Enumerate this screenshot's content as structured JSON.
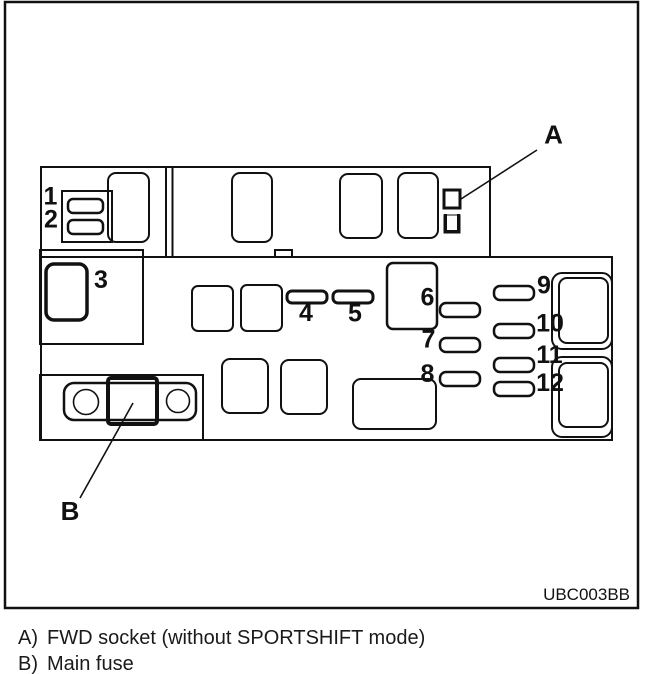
{
  "figure_code": "UBC003BB",
  "callouts": {
    "a": "A",
    "b": "B"
  },
  "fuse_labels": [
    "1",
    "2",
    "3",
    "4",
    "5",
    "6",
    "7",
    "8",
    "9",
    "10",
    "11",
    "12"
  ],
  "legend": [
    {
      "key": "A)",
      "text": "FWD socket (without SPORTSHIFT mode)"
    },
    {
      "key": "B)",
      "text": "Main fuse"
    }
  ],
  "colors": {
    "fuse_fill": "#b3b3b3",
    "line": "#111111",
    "paper": "#ffffff"
  }
}
